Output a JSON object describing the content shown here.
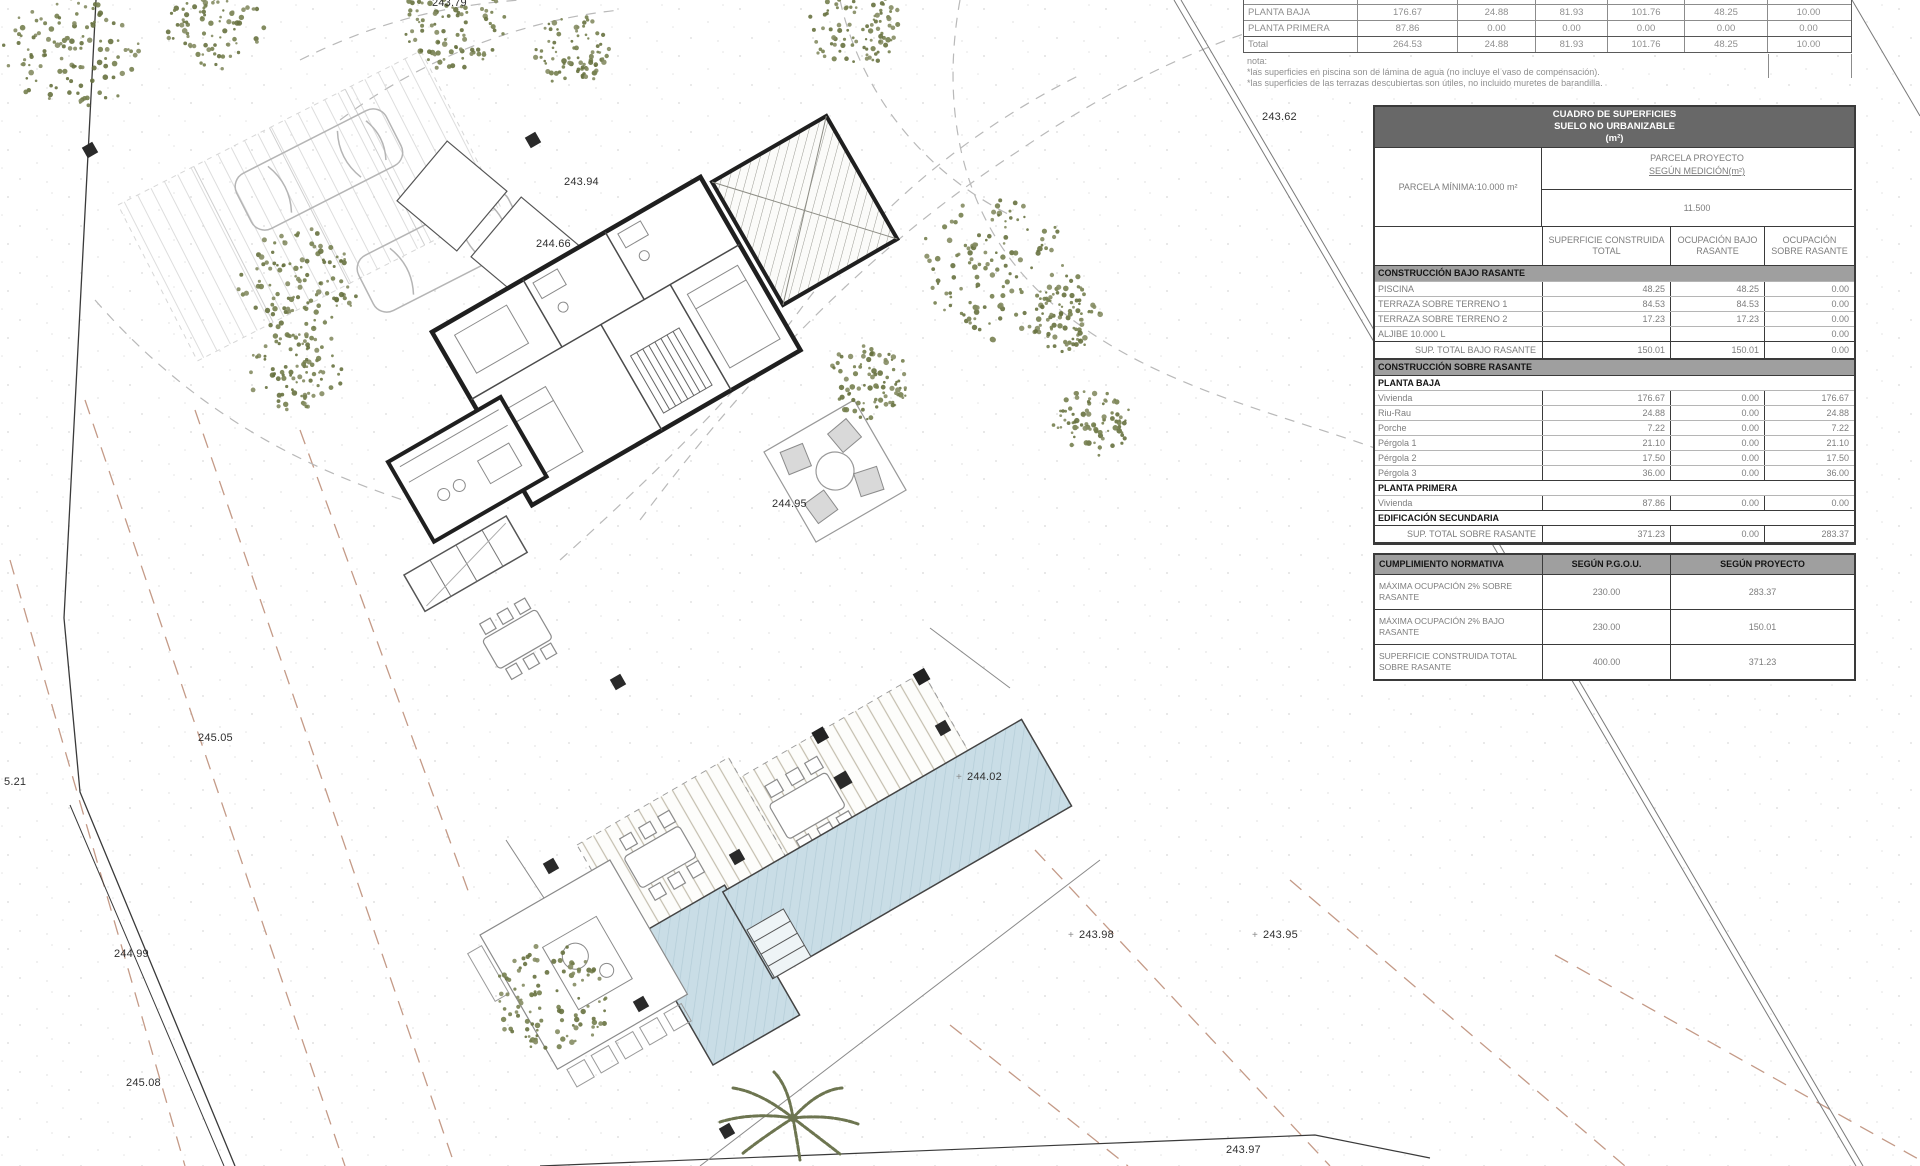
{
  "top_table": {
    "rows": [
      {
        "label": "PLANTA BAJA",
        "values": [
          "176.67",
          "24.88",
          "81.93",
          "101.76",
          "48.25",
          "10.00"
        ]
      },
      {
        "label": "PLANTA PRIMERA",
        "values": [
          "87.86",
          "0.00",
          "0.00",
          "0.00",
          "0.00",
          "0.00"
        ]
      },
      {
        "label": "Total",
        "values": [
          "264.53",
          "24.88",
          "81.93",
          "101.76",
          "48.25",
          "10.00"
        ]
      }
    ],
    "nota_label": "nota:",
    "notes": [
      "*las superficies en piscina son de lámina de agua (no incluye el vaso de compensación).",
      "*las superficies de las terrazas descubiertas son útiles, no incluido muretes de barandilla."
    ]
  },
  "surface_table": {
    "title_line1": "CUADRO DE SUPERFICIES",
    "title_line2": "SUELO NO URBANIZABLE",
    "title_line3": "(m²)",
    "parcela_minima_label": "PARCELA MÍNIMA:10.000 m²",
    "parcela_proyecto_line1": "PARCELA PROYECTO",
    "parcela_proyecto_line2": "SEGÚN MEDICIÓN(m²)",
    "parcela_proyecto_value": "11.500",
    "col_headers": [
      "SUPERFICIE CONSTRUIDA TOTAL",
      "OCUPACIÓN BAJO RASANTE",
      "OCUPACIÓN SOBRE RASANTE"
    ],
    "body": [
      {
        "type": "section",
        "label": "CONSTRUCCIÓN BAJO RASANTE"
      },
      {
        "type": "row",
        "label": "PISCINA",
        "values": [
          "48.25",
          "48.25",
          "0.00"
        ]
      },
      {
        "type": "row",
        "label": "TERRAZA SOBRE TERRENO 1",
        "values": [
          "84.53",
          "84.53",
          "0.00"
        ]
      },
      {
        "type": "row",
        "label": "TERRAZA SOBRE TERRENO 2",
        "values": [
          "17.23",
          "17.23",
          "0.00"
        ]
      },
      {
        "type": "row",
        "label": "ALJIBE 10.000 L",
        "values": [
          "",
          "",
          "0.00"
        ]
      },
      {
        "type": "total",
        "label": "SUP. TOTAL BAJO RASANTE",
        "values": [
          "150.01",
          "150.01",
          "0.00"
        ]
      },
      {
        "type": "section",
        "label": "CONSTRUCCIÓN SOBRE RASANTE"
      },
      {
        "type": "subheader",
        "label": "PLANTA BAJA"
      },
      {
        "type": "row",
        "label": "Vivienda",
        "values": [
          "176.67",
          "0.00",
          "176.67"
        ]
      },
      {
        "type": "row",
        "label": "Riu-Rau",
        "values": [
          "24.88",
          "0.00",
          "24.88"
        ]
      },
      {
        "type": "row",
        "label": "Porche",
        "values": [
          "7.22",
          "0.00",
          "7.22"
        ]
      },
      {
        "type": "row",
        "label": "Pérgola 1",
        "values": [
          "21.10",
          "0.00",
          "21.10"
        ]
      },
      {
        "type": "row",
        "label": "Pérgola 2",
        "values": [
          "17.50",
          "0.00",
          "17.50"
        ]
      },
      {
        "type": "row",
        "label": "Pérgola 3",
        "values": [
          "36.00",
          "0.00",
          "36.00"
        ]
      },
      {
        "type": "subheader",
        "label": "PLANTA PRIMERA"
      },
      {
        "type": "row",
        "label": "Vivienda",
        "values": [
          "87.86",
          "0.00",
          "0.00"
        ]
      },
      {
        "type": "subheader",
        "label": "EDIFICACIÓN SECUNDARIA"
      },
      {
        "type": "total",
        "label": "SUP. TOTAL SOBRE RASANTE",
        "values": [
          "371.23",
          "0.00",
          "283.37"
        ]
      }
    ]
  },
  "compliance_table": {
    "headers": [
      "CUMPLIMIENTO NORMATIVA",
      "SEGÚN P.G.O.U.",
      "SEGÚN PROYECTO"
    ],
    "rows": [
      {
        "label": "MÁXIMA OCUPACIÓN 2% SOBRE RASANTE",
        "pgou": "230.00",
        "proyecto": "283.37"
      },
      {
        "label": "MÁXIMA OCUPACIÓN 2% BAJO RASANTE",
        "pgou": "230.00",
        "proyecto": "150.01"
      },
      {
        "label": "SUPERFICIE CONSTRUIDA TOTAL SOBRE RASANTE",
        "pgou": "400.00",
        "proyecto": "371.23"
      }
    ]
  },
  "site_plan": {
    "elevation_labels": [
      {
        "text": "243.79",
        "x": 432,
        "y": -3,
        "cross": false
      },
      {
        "text": "243.94",
        "x": 564,
        "y": 176,
        "cross": false
      },
      {
        "text": "243.62",
        "x": 1262,
        "y": 111,
        "cross": false
      },
      {
        "text": "244.66",
        "x": 536,
        "y": 238,
        "cross": false
      },
      {
        "text": "244.95",
        "x": 772,
        "y": 498,
        "cross": false
      },
      {
        "text": "245.05",
        "x": 198,
        "y": 732,
        "cross": false
      },
      {
        "text": "5.21",
        "x": 4,
        "y": 776,
        "cross": false
      },
      {
        "text": "244.99",
        "x": 114,
        "y": 948,
        "cross": false
      },
      {
        "text": "245.08",
        "x": 126,
        "y": 1077,
        "cross": false
      },
      {
        "text": "244.02",
        "x": 956,
        "y": 771,
        "cross": true
      },
      {
        "text": "243.98",
        "x": 1068,
        "y": 929,
        "cross": true
      },
      {
        "text": "243.95",
        "x": 1252,
        "y": 929,
        "cross": true
      },
      {
        "text": "243.97",
        "x": 1226,
        "y": 1144,
        "cross": false
      }
    ],
    "colors": {
      "pool_fill": "#c9dde6",
      "tree_olive": "#76804f",
      "contour": "#c49a87",
      "wall": "#1f1f1f"
    }
  }
}
